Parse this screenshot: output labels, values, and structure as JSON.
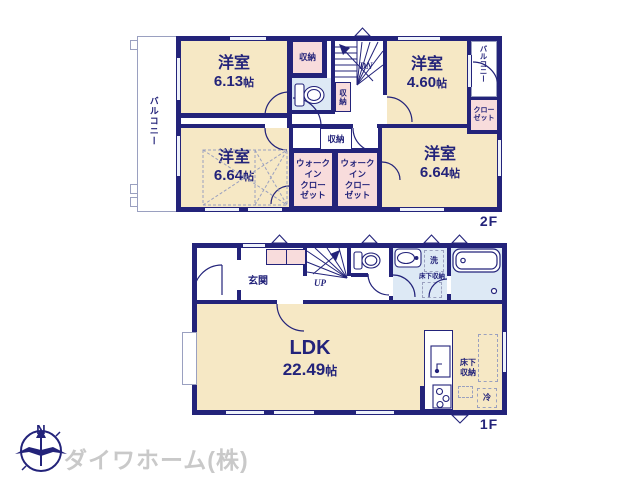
{
  "floor2": {
    "floor_label": "2F",
    "balcony_left_label": "バルコニー",
    "balcony_right_label": "バルコニー",
    "room_a": {
      "name": "洋室",
      "size": "6.13",
      "unit": "帖"
    },
    "room_b": {
      "name": "洋室",
      "size": "4.60",
      "unit": "帖"
    },
    "room_c": {
      "name": "洋室",
      "size": "6.64",
      "unit": "帖"
    },
    "room_d": {
      "name": "洋室",
      "size": "6.64",
      "unit": "帖"
    },
    "storage_top": "収納",
    "storage_side": "収納",
    "storage_mid": "収納",
    "closet": "クロー\nゼット",
    "wic_left": "ウォーク\nイン\nクロー\nゼット",
    "wic_right": "ウォーク\nイン\nクロー\nゼット",
    "stairs_down": "DN"
  },
  "floor1": {
    "floor_label": "1F",
    "entrance_label": "玄関",
    "stairs_up": "UP",
    "laundry_label": "洗",
    "underfloor_storage_washroom": "床下収納",
    "underfloor_storage_kitchen": "床下\n収納",
    "fridge_label": "冷",
    "ldk": {
      "name": "LDK",
      "size": "22.49",
      "unit": "帖"
    }
  },
  "logo": {
    "compass_north": "N",
    "company_name": "ダイワホーム(株)"
  },
  "colors": {
    "wall_navy": "#23237a",
    "room_beige": "#f6e8c5",
    "closet_pink": "#f8dcdc",
    "wet_area_blue": "#dde9f5",
    "logo_gray": "#c9c9c9"
  }
}
